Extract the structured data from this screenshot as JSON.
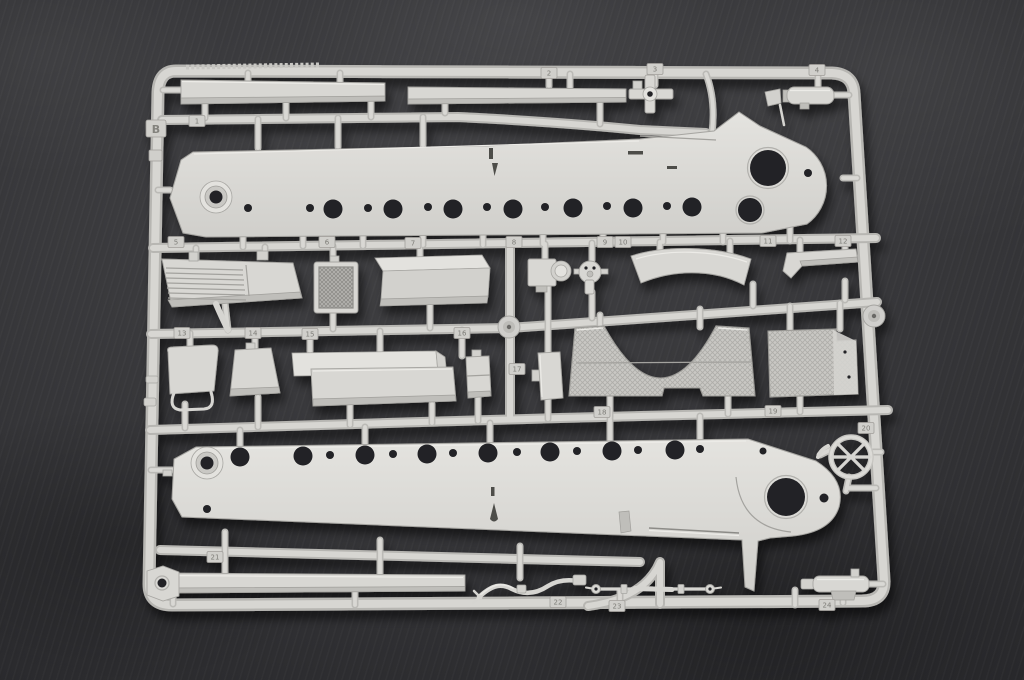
{
  "sprue": {
    "letter": "B",
    "tags": [
      {
        "value": "1"
      },
      {
        "value": "2"
      },
      {
        "value": "3"
      },
      {
        "value": "4"
      },
      {
        "value": "5"
      },
      {
        "value": "6"
      },
      {
        "value": "7"
      },
      {
        "value": "8"
      },
      {
        "value": "9"
      },
      {
        "value": "10"
      },
      {
        "value": "11"
      },
      {
        "value": "12"
      },
      {
        "value": "13"
      },
      {
        "value": "14"
      },
      {
        "value": "15"
      },
      {
        "value": "16"
      },
      {
        "value": "17"
      },
      {
        "value": "18"
      },
      {
        "value": "19"
      },
      {
        "value": "20"
      },
      {
        "value": "21"
      },
      {
        "value": "22"
      },
      {
        "value": "23"
      },
      {
        "value": "24"
      }
    ],
    "colors": {
      "plastic": "#d8d7d3",
      "plastic_shadow": "#bcbbb7",
      "plastic_highlight": "#ebeae6",
      "mesh_plastic": "#c8c7c3",
      "background": "#2b2b2e",
      "hole": "#232326"
    }
  }
}
